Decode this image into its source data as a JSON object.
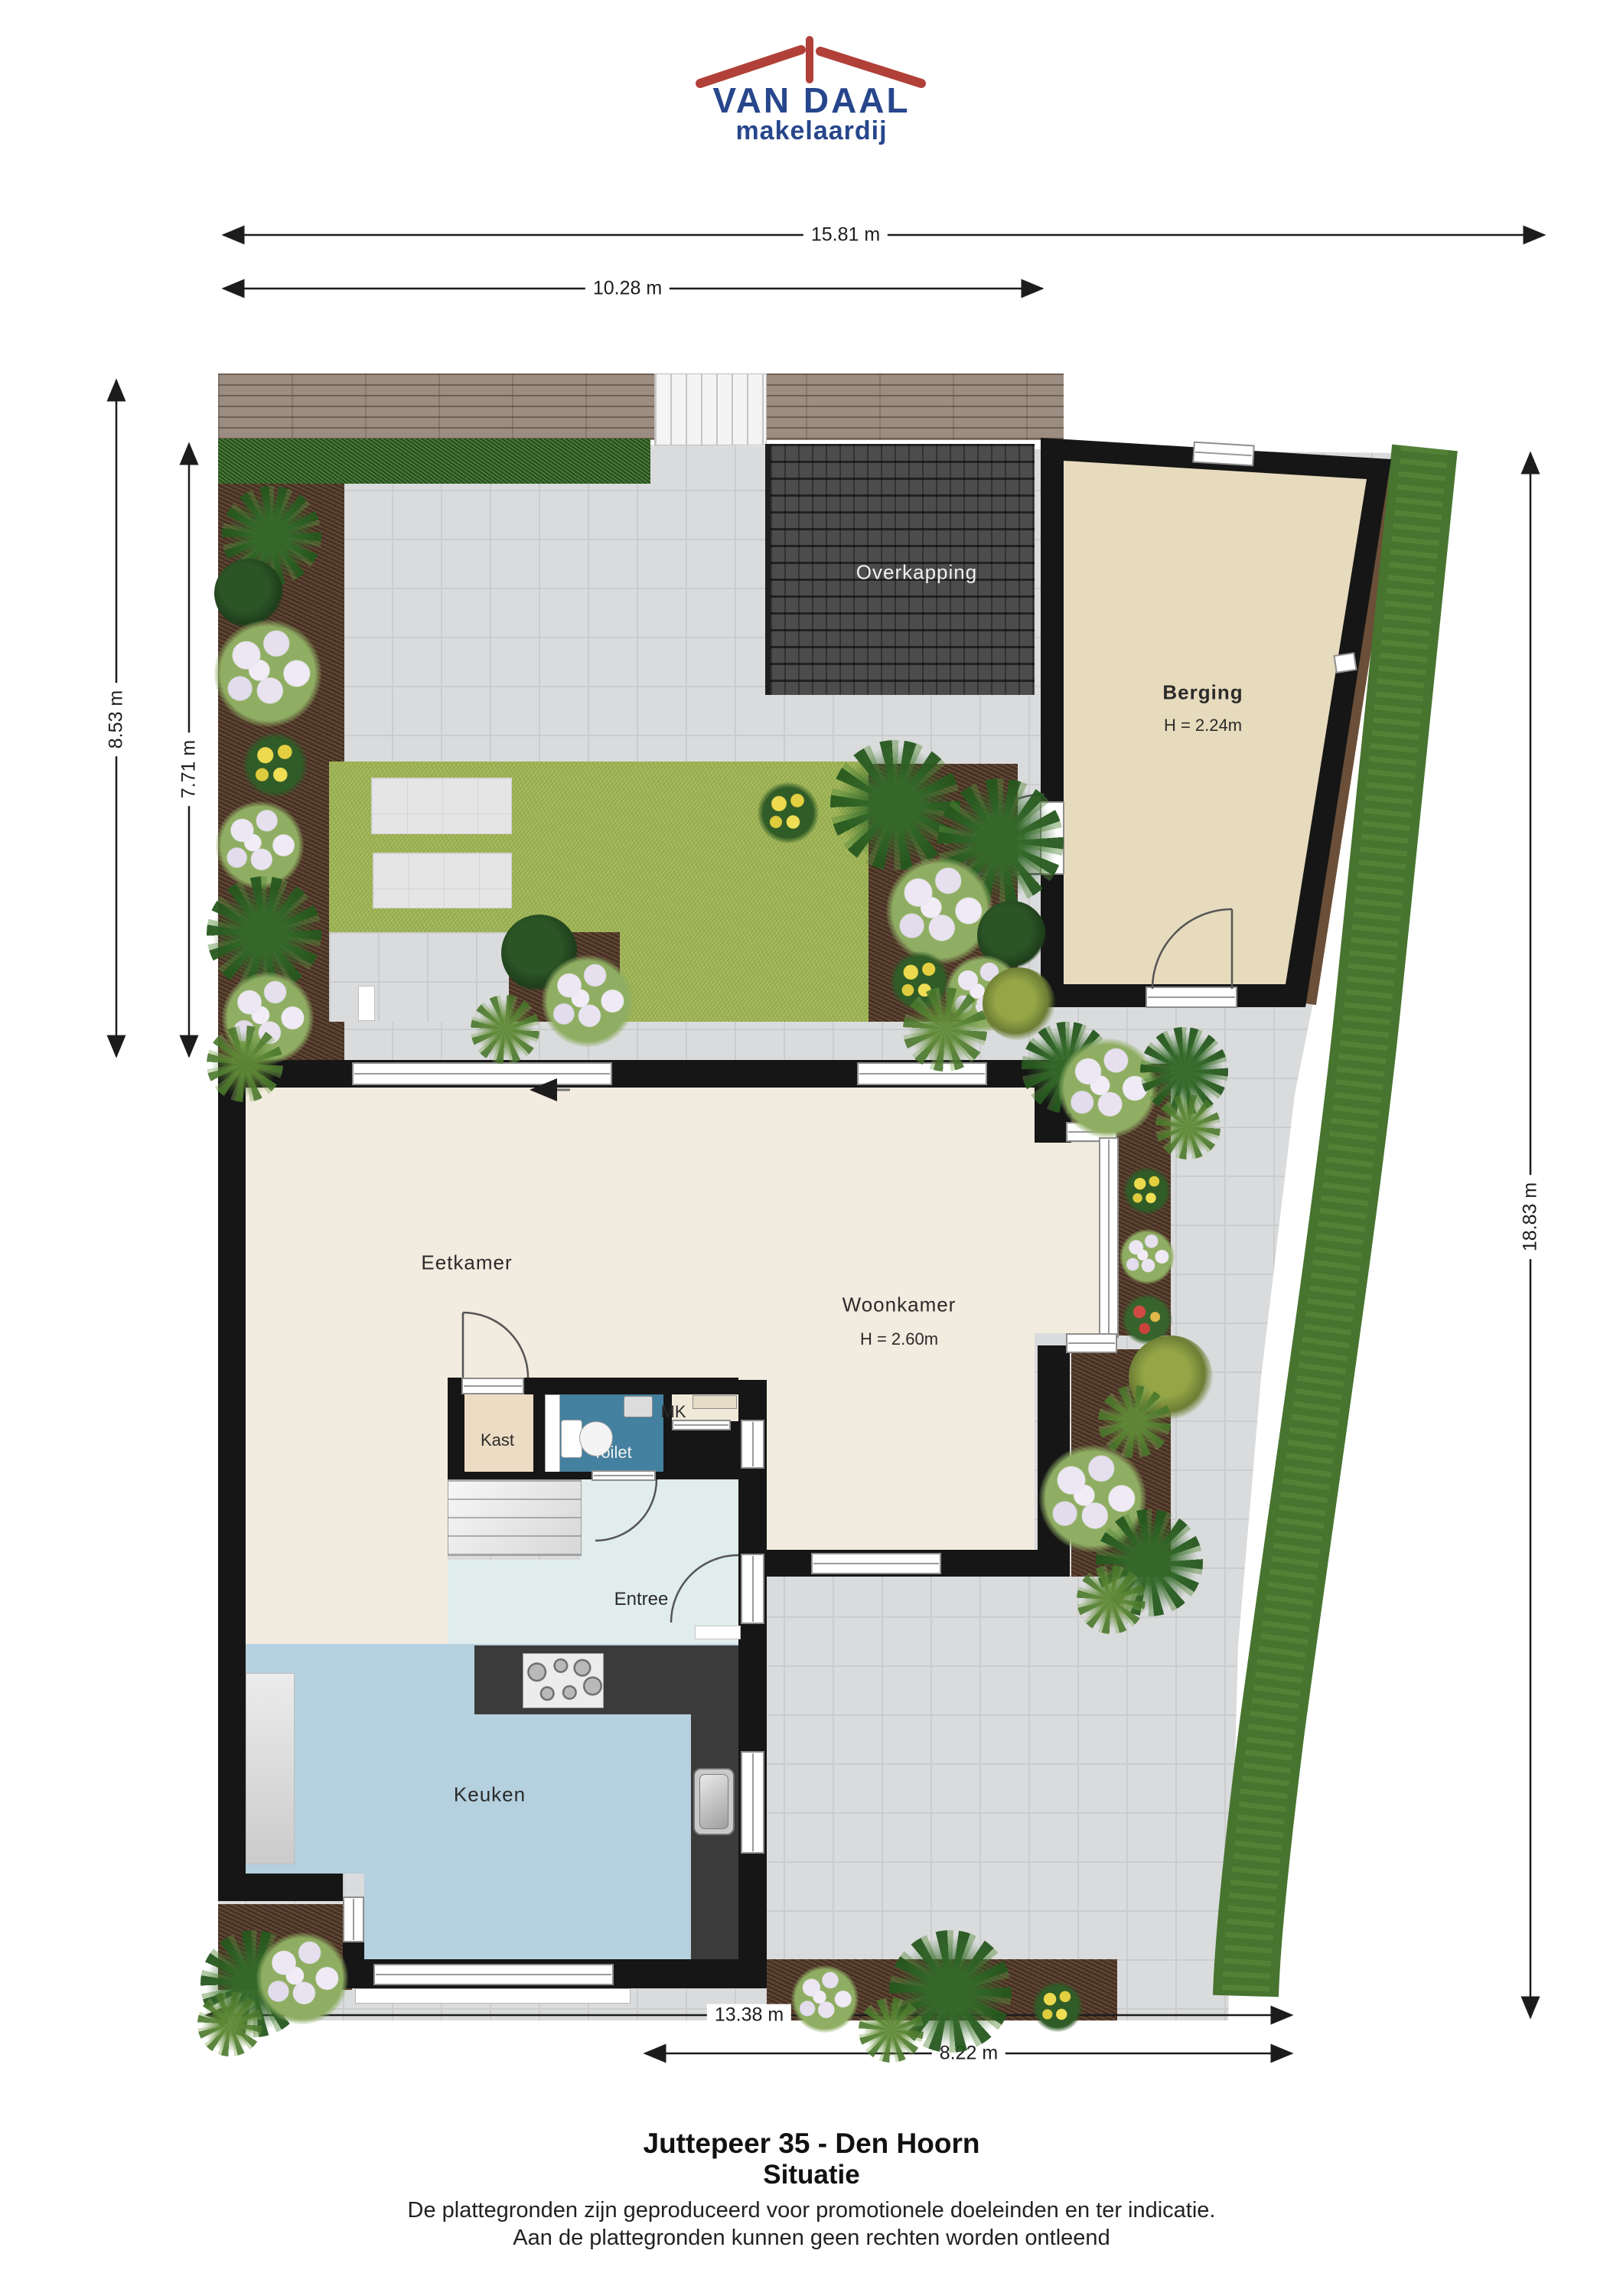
{
  "logo": {
    "name": "VAN DAAL",
    "tagline": "makelaardij"
  },
  "dimensions": {
    "total_width": "15.81 m",
    "garden_width": "10.28 m",
    "garden_depth": "8.53 m",
    "garden_depth_inner": "7.71 m",
    "plot_depth": "18.83 m",
    "house_width": "13.38 m",
    "house_width_inner": "8.22 m"
  },
  "rooms": {
    "overkapping": "Overkapping",
    "berging": "Berging",
    "berging_height": "H = 2.24m",
    "eetkamer": "Eetkamer",
    "woonkamer": "Woonkamer",
    "woonkamer_height": "H = 2.60m",
    "kast": "Kast",
    "toilet": "Toilet",
    "mk": "MK",
    "entree": "Entree",
    "keuken": "Keuken"
  },
  "footer": {
    "title": "Juttepeer 35 - Den Hoorn",
    "subtitle": "Situatie",
    "disclaimer1": "De plattegronden zijn geproduceerd voor promotionele doeleinden en ter indicatie.",
    "disclaimer2": "Aan de plattegronden kunnen geen rechten worden ontleend"
  },
  "colors": {
    "brand_blue": "#27468c",
    "brand_red": "#b04038",
    "wall": "#161616",
    "floor_living": "#f2ebdf",
    "floor_kitchen": "#b5d0de",
    "floor_toilet": "#44809f",
    "floor_entree": "#e0edec",
    "floor_kast": "#ecdcc3",
    "floor_berging": "#e7dbbd",
    "lawn": "#a6bb5e",
    "paving": "#dadbdc",
    "soil": "#5b4232",
    "hedge": "#47742f",
    "deck": "#9c8d82",
    "roof_overkapping": "#4c4c4c"
  }
}
